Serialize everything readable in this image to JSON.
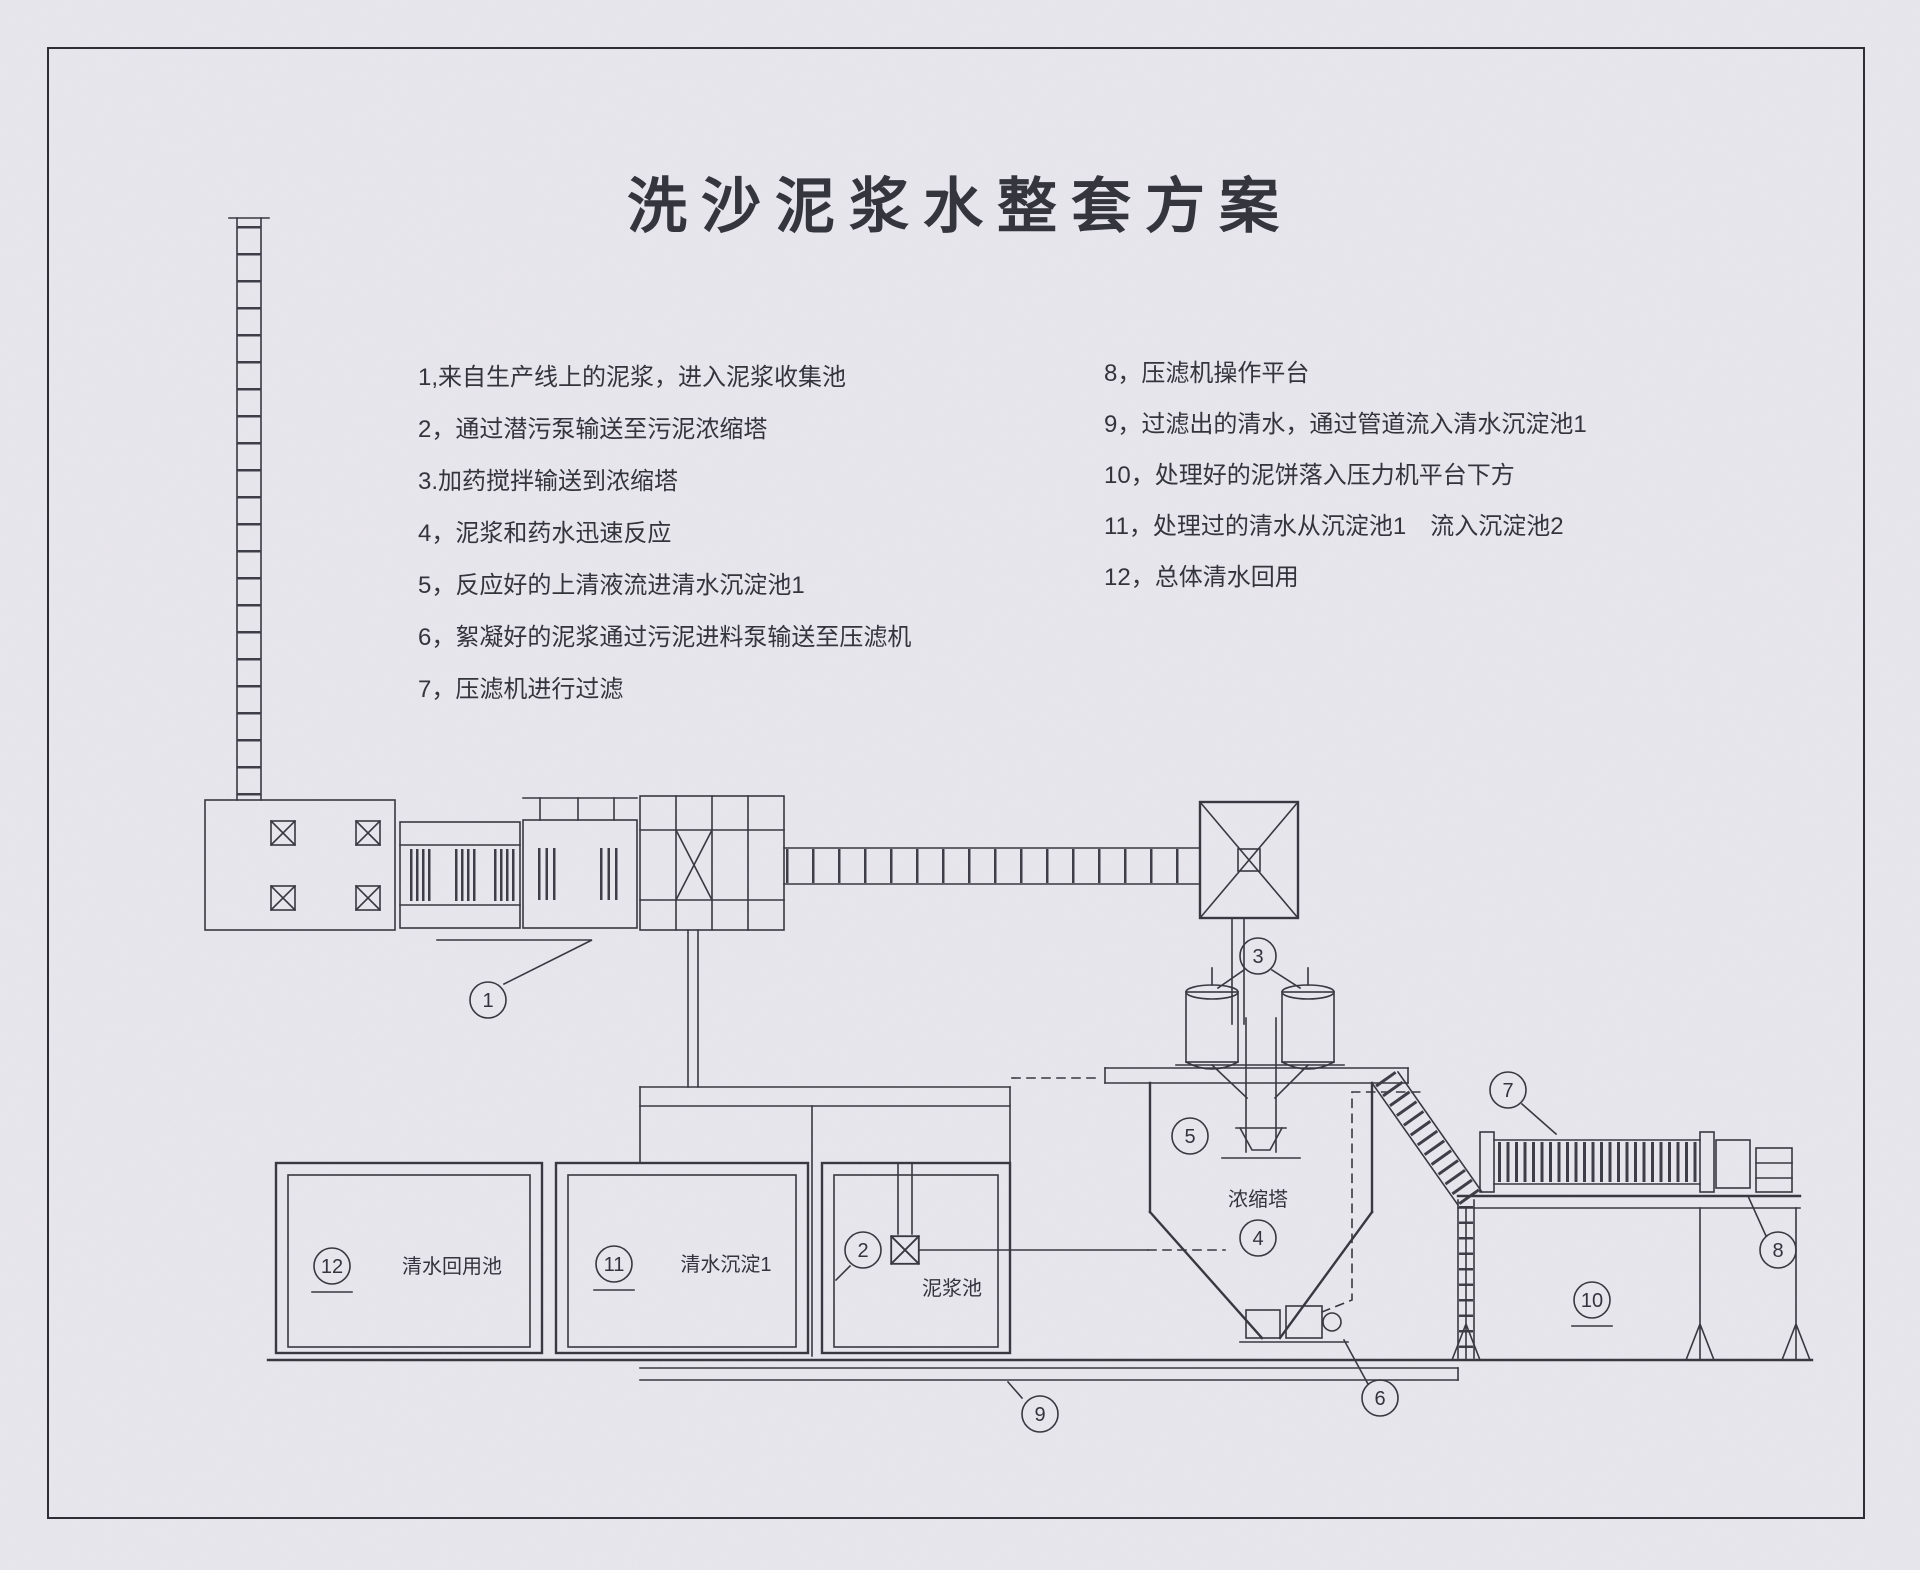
{
  "title": "洗沙泥浆水整套方案",
  "notes": {
    "left": [
      "1,来自生产线上的泥浆，进入泥浆收集池",
      "2，通过潜污泵输送至污泥浓缩塔",
      "3.加药搅拌输送到浓缩塔",
      "4，泥浆和药水迅速反应",
      "5，反应好的上清液流进清水沉淀池1",
      "6，絮凝好的泥浆通过污泥进料泵输送至压滤机",
      "7，压滤机进行过滤"
    ],
    "right": [
      "8，压滤机操作平台",
      "9，过滤出的清水，通过管道流入清水沉淀池1",
      "10，处理好的泥饼落入压力机平台下方",
      "11，处理过的清水从沉淀池1　流入沉淀池2",
      "12，总体清水回用"
    ]
  },
  "diagram": {
    "labels": {
      "clear_reuse_tank": "清水回用池",
      "clear_settling_tank_1": "清水沉淀1",
      "mud_tank": "泥浆池",
      "thickener": "浓缩塔"
    },
    "callouts": {
      "c1": "1",
      "c2": "2",
      "c3": "3",
      "c4": "4",
      "c5": "5",
      "c6": "6",
      "c7": "7",
      "c8": "8",
      "c9": "9",
      "c10": "10",
      "c11": "11",
      "c12": "12"
    }
  },
  "colors": {
    "paper": "#e9e7ee",
    "ink": "#34343c"
  }
}
